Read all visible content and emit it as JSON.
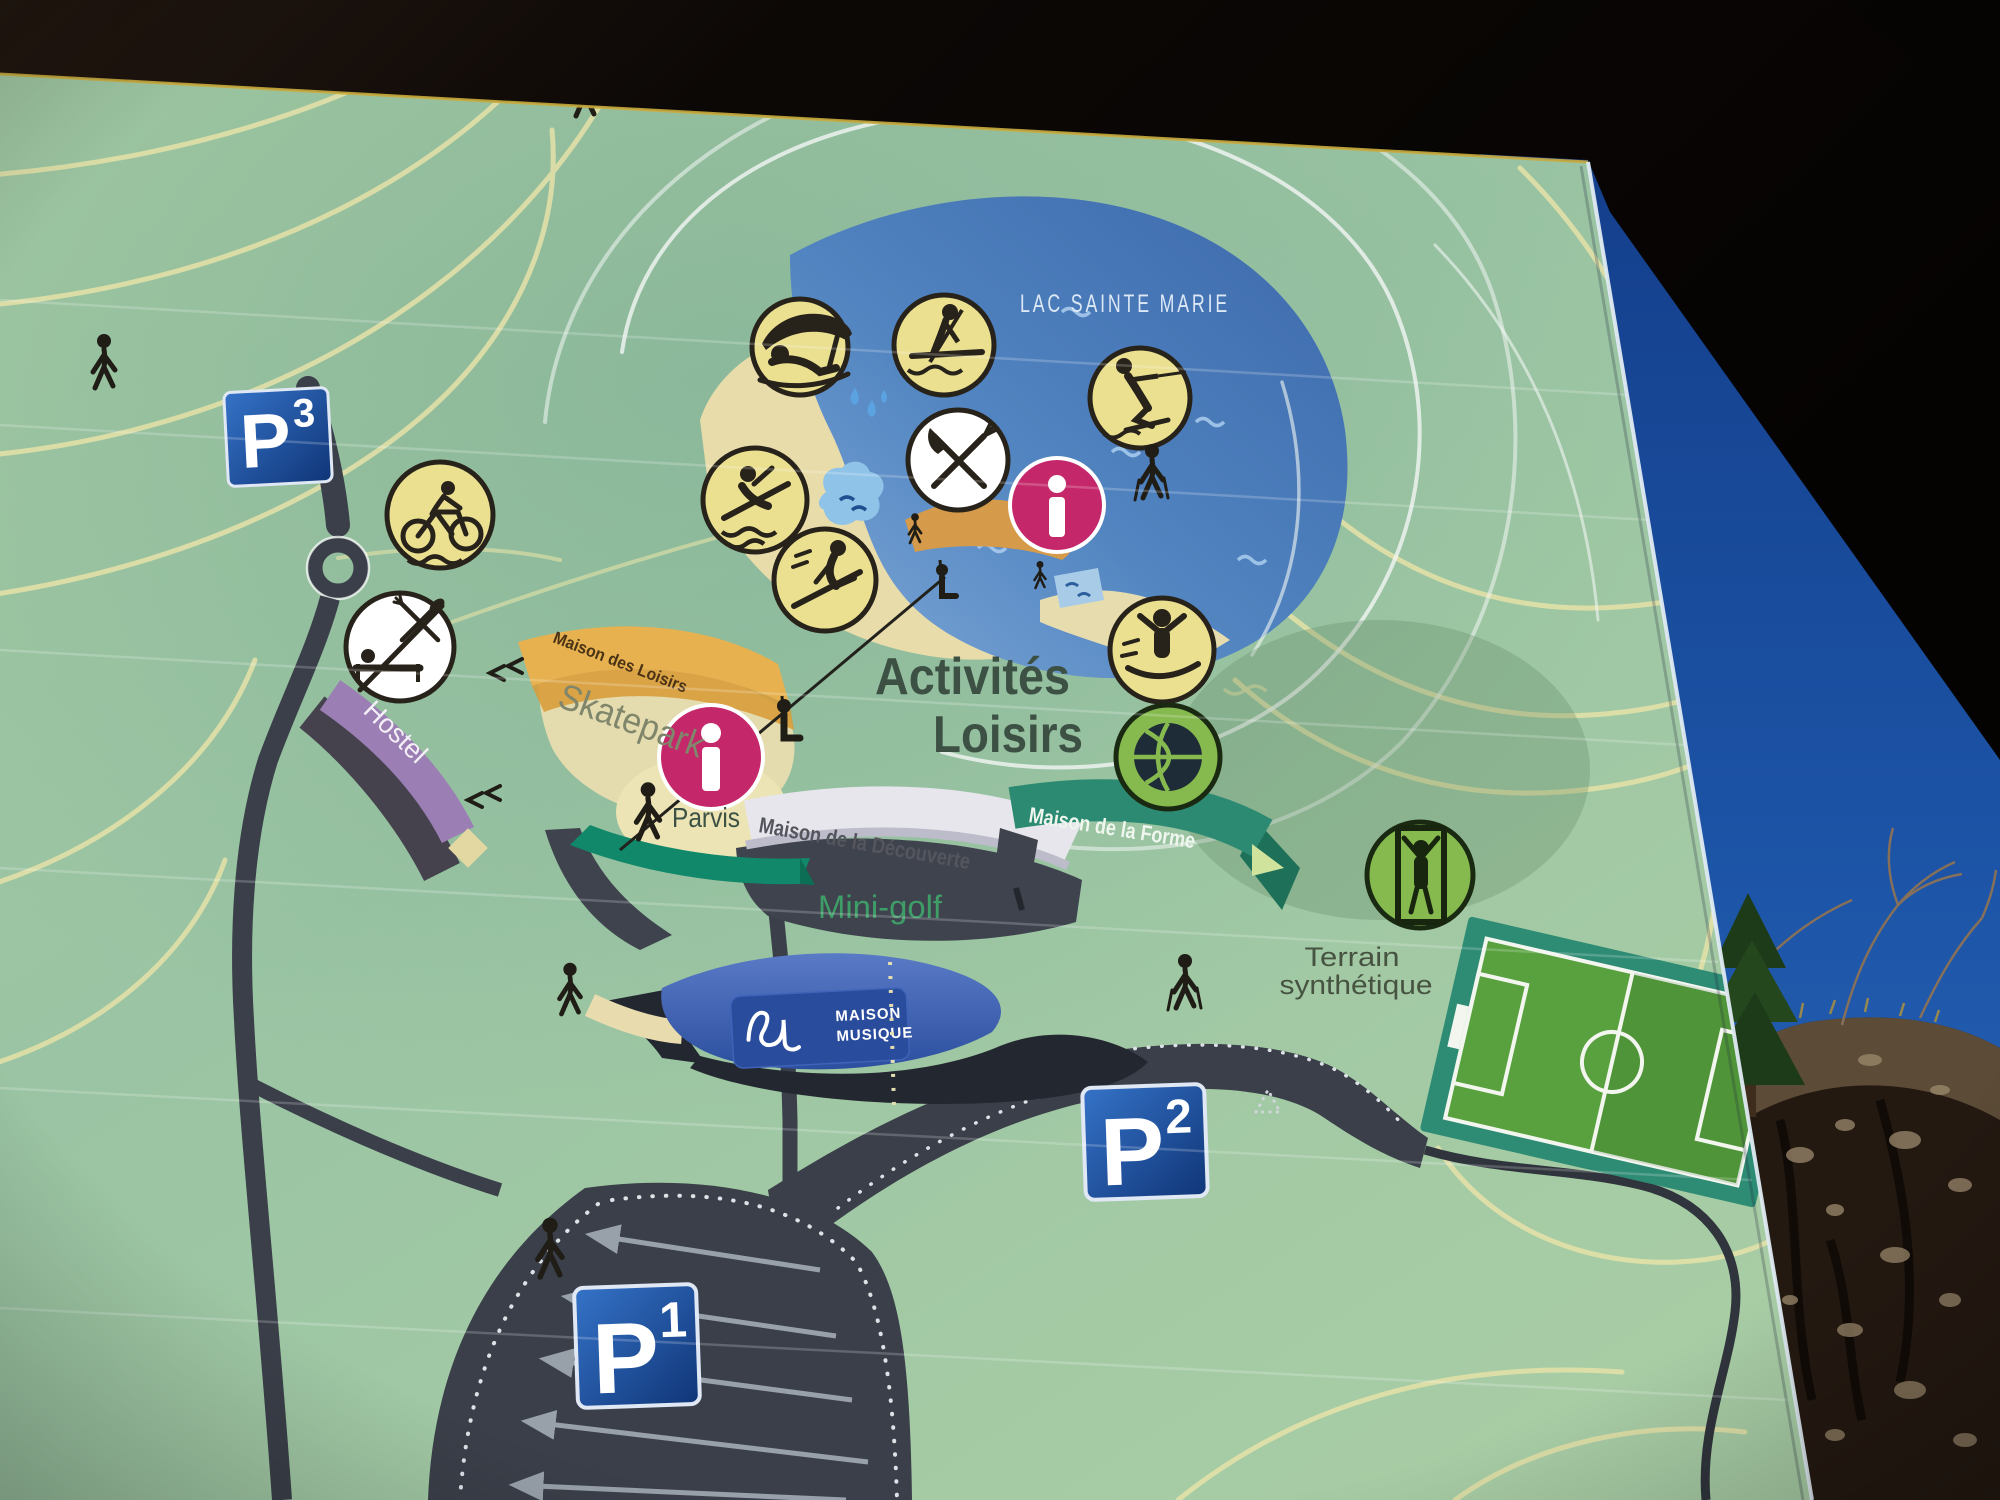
{
  "map": {
    "lake_label": "LAC SAINTE MARIE",
    "activities_title": {
      "line1": "Activités",
      "line2": "Loisirs"
    },
    "places": {
      "maison_des_loisirs": "Maison des Loisirs",
      "skatepark": "Skatepark",
      "hostel": "Hostel",
      "parvis": "Parvis",
      "maison_de_la_decouverte": "Maison de la Découverte",
      "maison_de_la_forme": "Maison de la Forme",
      "mini_golf": "Mini-golf",
      "terrain_synthetique_line1": "Terrain",
      "terrain_synthetique_line2": "synthétique"
    },
    "maison_musique": {
      "line1": "MAISON",
      "line2": "MUSIQUE"
    },
    "parking": {
      "p1": {
        "letter": "P",
        "number": "1"
      },
      "p2": {
        "letter": "P",
        "number": "2"
      },
      "p3": {
        "letter": "P",
        "number": "3"
      }
    },
    "icons": [
      {
        "name": "parasol-beach-icon",
        "meaning": "beach / sunbathing"
      },
      {
        "name": "stand-up-paddle-icon",
        "meaning": "paddle boarding on lake"
      },
      {
        "name": "water-ski-icon",
        "meaning": "water skiing"
      },
      {
        "name": "restaurant-icon",
        "meaning": "restaurant"
      },
      {
        "name": "info-icon-lake",
        "meaning": "information point"
      },
      {
        "name": "water-slide-icon",
        "meaning": "swimming / water slide"
      },
      {
        "name": "summer-sled-icon",
        "meaning": "summer sledging"
      },
      {
        "name": "trampoline-icon",
        "meaning": "fitness / play area"
      },
      {
        "name": "basketball-icon",
        "meaning": "basketball court"
      },
      {
        "name": "mountain-bike-icon",
        "meaning": "mountain biking"
      },
      {
        "name": "hostel-restaurant-icon",
        "meaning": "hostel with restaurant and beds"
      },
      {
        "name": "climbing-icon",
        "meaning": "climbing frame"
      },
      {
        "name": "info-icon-parvis",
        "meaning": "information point"
      },
      {
        "name": "chairlift-seat-icon",
        "meaning": "zip-line seats"
      },
      {
        "name": "pedestrian-icon",
        "meaning": "walking figures on paths"
      }
    ],
    "colors": {
      "board_green": "#9fc7a4",
      "lake_blue": "#4a7cba",
      "contour_yellow": "#e6e2a8",
      "road_dark": "#3a3f49",
      "info_magenta": "#c5286a",
      "activity_icon_yellow": "#ebdf90",
      "sport_icon_green": "#86ba4e",
      "parking_sign_blue": "#1d4f9f",
      "hostel_purple": "#9b7eb4",
      "forme_teal": "#2b8a71",
      "minigolf_teal": "#11886a",
      "musique_blue": "#2a4c9c",
      "decouverte_silver": "#e6e6ec",
      "sand_beach": "#e9dcab",
      "sky_blue": "#1d55a8"
    }
  }
}
